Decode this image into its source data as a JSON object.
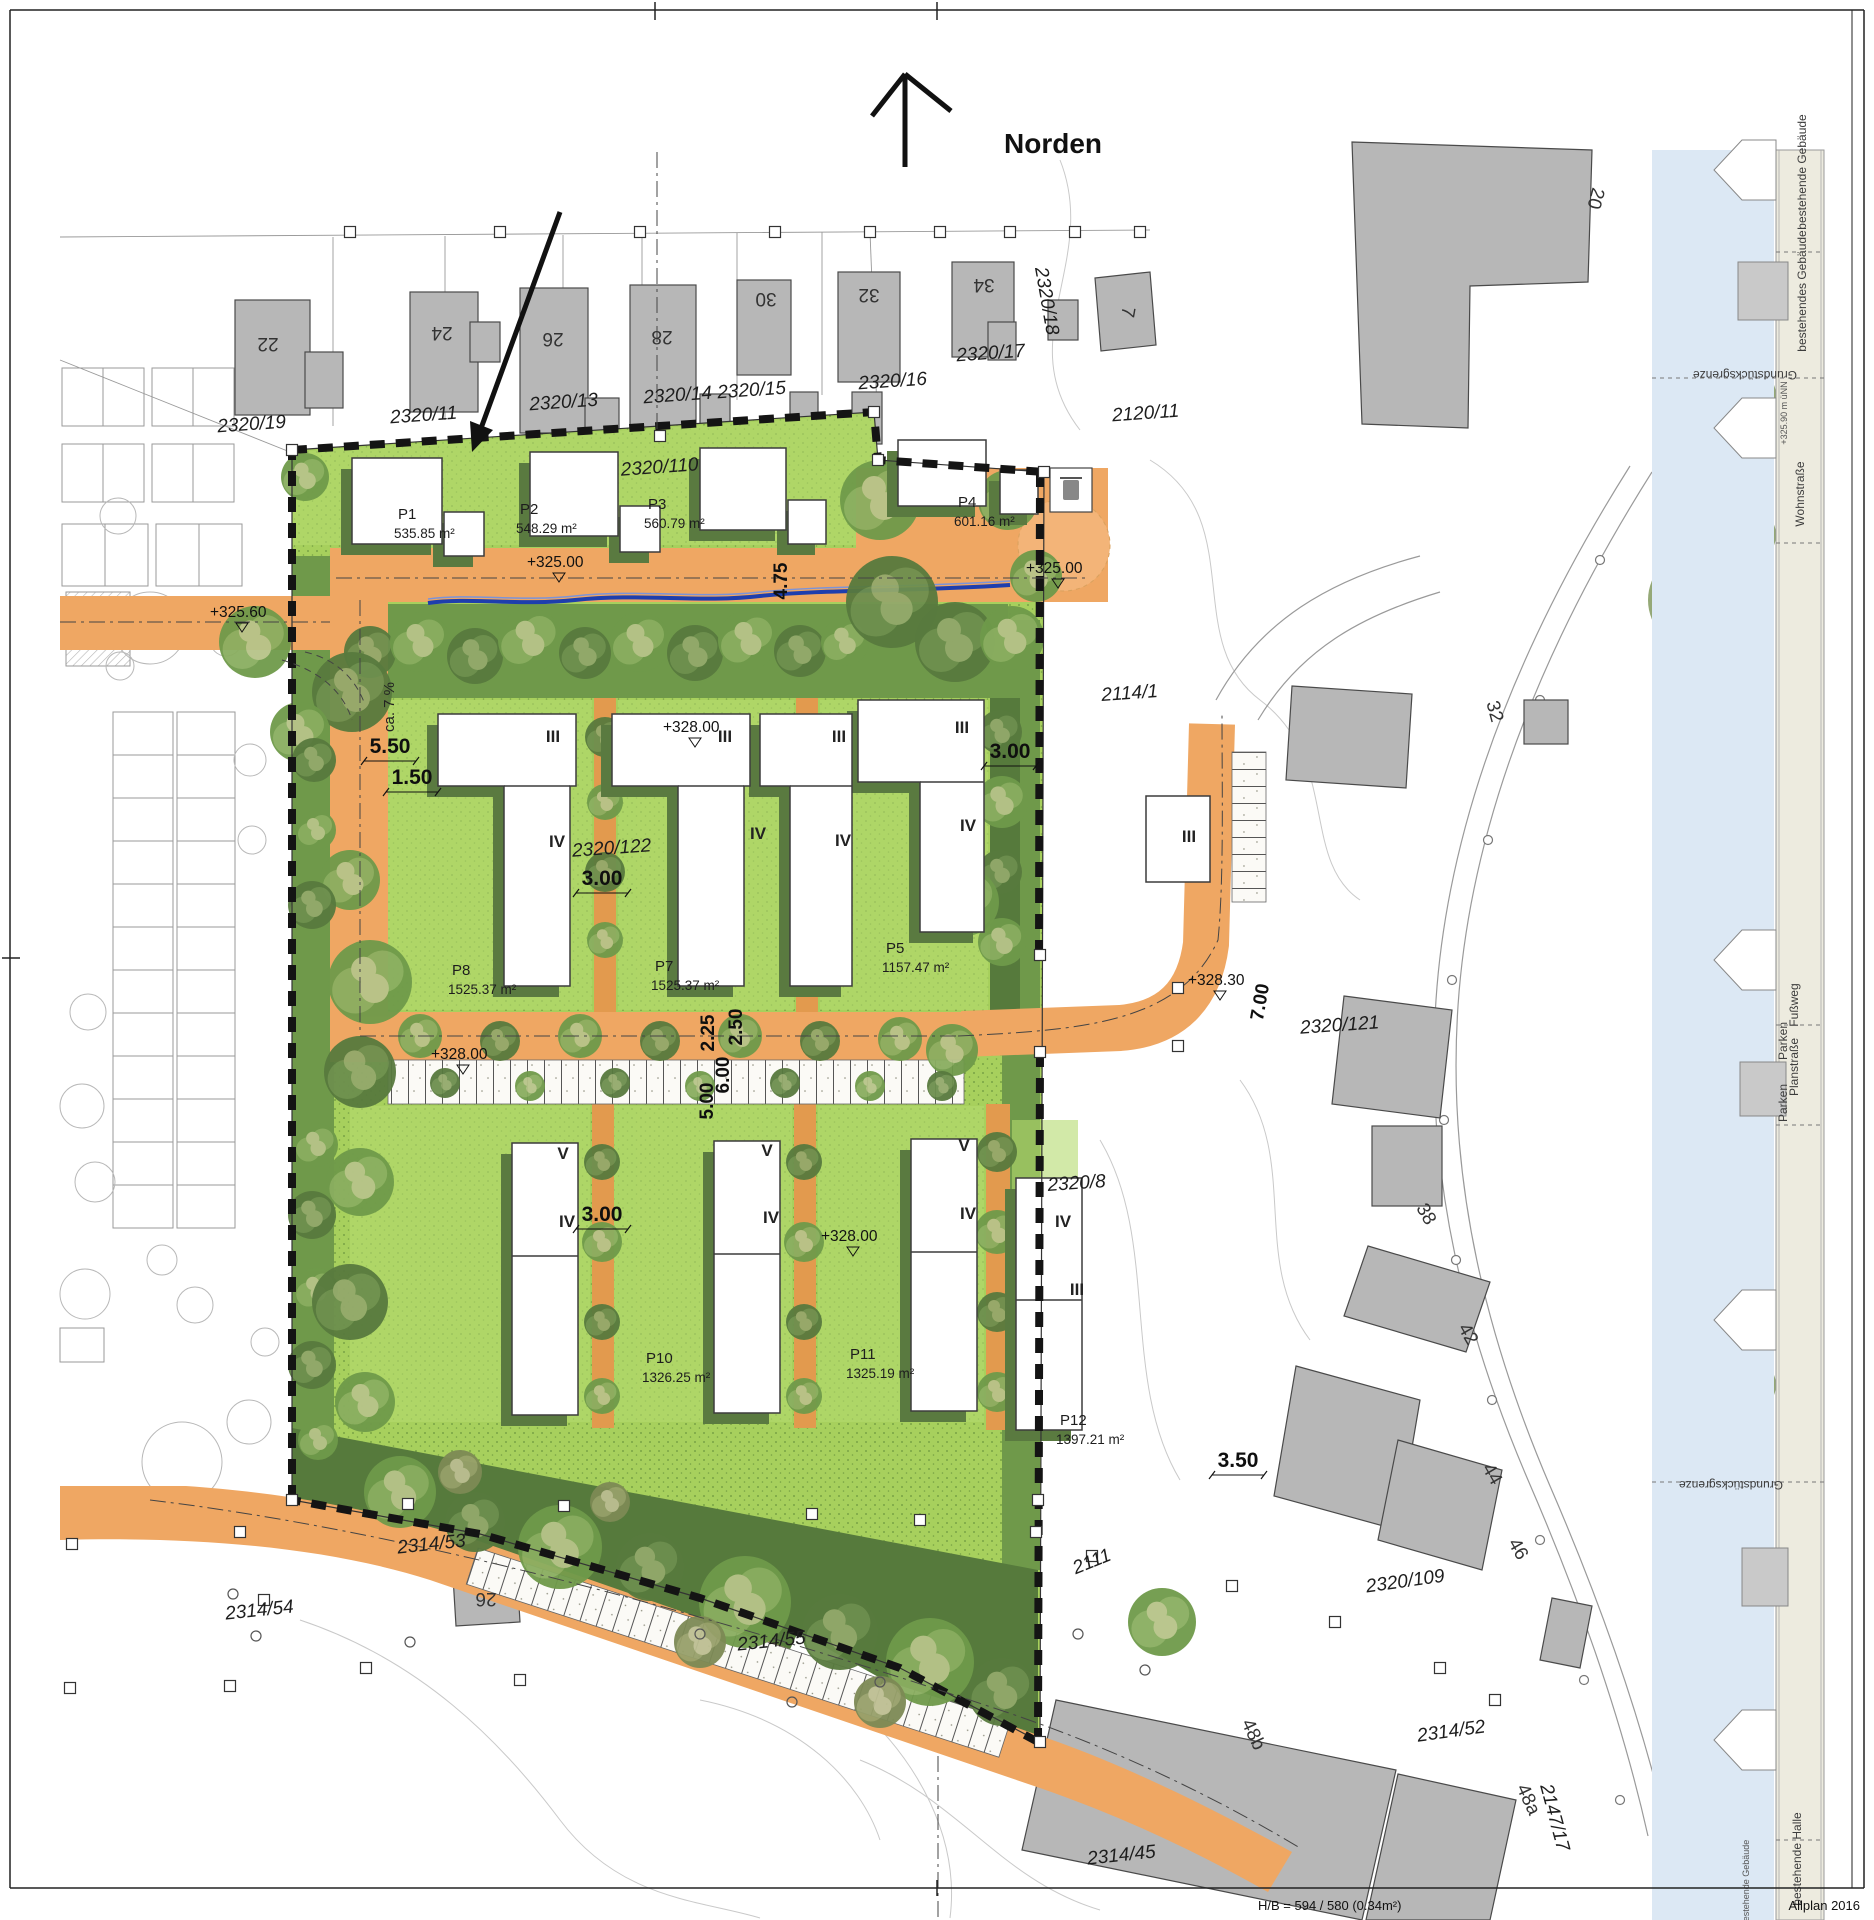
{
  "meta": {
    "north_label": "Norden",
    "footer_scale": "H/B = 594 / 580 (0.34m²)",
    "footer_app": "Allplan 2016"
  },
  "colors": {
    "site_green": "#a7d05d",
    "buffer_green": "#6f994a",
    "dark_green": "#567a3c",
    "road_orange": "#efa763",
    "existing_building_gray": "#b7b7b7",
    "new_building_white": "#ffffff",
    "shadow_olive": "#5a7a40",
    "swale_blue": "#1e3ead",
    "sky_blue": "#dce8f4"
  },
  "parcels": [
    [
      "P1",
      "535.85 m²",
      398,
      519
    ],
    [
      "P2",
      "548.29 m²",
      520,
      514
    ],
    [
      "P3",
      "560.79 m²",
      648,
      509
    ],
    [
      "P4",
      "601.16 m²",
      958,
      507
    ],
    [
      "P5",
      "1157.47 m²",
      886,
      953
    ],
    [
      "P7",
      "1525.37 m²",
      655,
      971
    ],
    [
      "P8",
      "1525.37 m²",
      452,
      975
    ],
    [
      "P10",
      "1326.25 m²",
      646,
      1363
    ],
    [
      "P11",
      "1325.19 m²",
      850,
      1359
    ],
    [
      "P12",
      "1397.21 m²",
      1060,
      1425
    ]
  ],
  "map": {
    "labels": [
      [
        "plot",
        "2320/19",
        252,
        430,
        -4
      ],
      [
        "plot",
        "2320/11",
        424,
        421,
        -4
      ],
      [
        "plot",
        "2320/13",
        564,
        408,
        -4
      ],
      [
        "plot",
        "2320/14",
        678,
        401,
        -4
      ],
      [
        "plot",
        "2320/15",
        752,
        396,
        -4
      ],
      [
        "plot",
        "2320/16",
        893,
        387,
        -4
      ],
      [
        "plot",
        "2320/17",
        991,
        359,
        -4
      ],
      [
        "plot",
        "2320/18",
        1041,
        302,
        80
      ],
      [
        "plot",
        "2120/11",
        1146,
        419,
        -4
      ],
      [
        "plot",
        "2320/110",
        660,
        473,
        -4
      ],
      [
        "plot",
        "2320/122",
        612,
        854,
        -4
      ],
      [
        "plot",
        "2114/1",
        1130,
        699,
        -4
      ],
      [
        "plot",
        "2320/121",
        1340,
        1031,
        -4
      ],
      [
        "plot",
        "2320/8",
        1077,
        1189,
        -4
      ],
      [
        "plot",
        "2111",
        1094,
        1567,
        -22
      ],
      [
        "plot",
        "2320/109",
        1406,
        1587,
        -8
      ],
      [
        "plot",
        "2314/53",
        432,
        1550,
        -6
      ],
      [
        "plot",
        "2314/54",
        260,
        1616,
        -6
      ],
      [
        "plot",
        "2314/55",
        772,
        1647,
        -6
      ],
      [
        "plot",
        "2314/52",
        1452,
        1737,
        -8
      ],
      [
        "plot",
        "2314/45",
        1122,
        1861,
        -6
      ],
      [
        "plot",
        "2147/17",
        1549,
        1819,
        75
      ],
      [
        "house",
        "22",
        268,
        338,
        180
      ],
      [
        "house",
        "24",
        442,
        327,
        180
      ],
      [
        "house",
        "26",
        553,
        333,
        180
      ],
      [
        "house",
        "28",
        662,
        331,
        180
      ],
      [
        "house",
        "30",
        766,
        293,
        180
      ],
      [
        "house",
        "32",
        869,
        289,
        180
      ],
      [
        "house",
        "34",
        984,
        279,
        180
      ],
      [
        "house",
        "7",
        1122,
        311,
        100
      ],
      [
        "house",
        "20",
        1590,
        197,
        105
      ],
      [
        "house",
        "32",
        1489,
        713,
        75
      ],
      [
        "house",
        "38",
        1421,
        1217,
        60
      ],
      [
        "house",
        "42",
        1463,
        1337,
        60
      ],
      [
        "house",
        "44",
        1487,
        1477,
        60
      ],
      [
        "house",
        "46",
        1513,
        1552,
        60
      ],
      [
        "house",
        "48b",
        1248,
        1737,
        65
      ],
      [
        "house",
        "48a",
        1523,
        1802,
        65
      ],
      [
        "house",
        "26",
        486,
        1593,
        180
      ],
      [
        "dim",
        "5.50",
        390,
        753
      ],
      [
        "dim",
        "1.50",
        412,
        784
      ],
      [
        "dim",
        "3.00",
        602,
        885
      ],
      [
        "dim",
        "3.00",
        1010,
        758
      ],
      [
        "dim",
        "3.00",
        602,
        1221
      ],
      [
        "dim",
        "3.50",
        1238,
        1467
      ],
      [
        "dimR",
        "2.25",
        714,
        1033,
        -90
      ],
      [
        "dimR",
        "2.50",
        742,
        1027,
        -90
      ],
      [
        "dimR",
        "6.00",
        729,
        1075,
        -90
      ],
      [
        "dimR",
        "5.00",
        713,
        1101,
        -90
      ],
      [
        "dimR",
        "7.00",
        1266,
        1003,
        -80
      ],
      [
        "dimR",
        "4.75",
        787,
        581,
        -90
      ],
      [
        "dimS",
        "ca. 7 %",
        394,
        707,
        -90
      ],
      [
        "elev",
        "+325.60",
        210,
        617
      ],
      [
        "elev",
        "+325.00",
        527,
        567
      ],
      [
        "elev",
        "+325.00",
        1026,
        573
      ],
      [
        "elev",
        "+328.00",
        663,
        732
      ],
      [
        "elev",
        "+328.00",
        431,
        1059
      ],
      [
        "elev",
        "+328.00",
        821,
        1241
      ],
      [
        "elev",
        "+328.30",
        1188,
        985
      ],
      [
        "floor",
        "III",
        553,
        742
      ],
      [
        "floor",
        "IV",
        557,
        847
      ],
      [
        "floor",
        "III",
        725,
        742
      ],
      [
        "floor",
        "IV",
        758,
        839
      ],
      [
        "floor",
        "III",
        839,
        742
      ],
      [
        "floor",
        "IV",
        843,
        846
      ],
      [
        "floor",
        "III",
        962,
        733
      ],
      [
        "floor",
        "IV",
        968,
        831
      ],
      [
        "floor",
        "III",
        1189,
        842
      ],
      [
        "floor",
        "V",
        563,
        1159
      ],
      [
        "floor",
        "IV",
        567,
        1227
      ],
      [
        "floor",
        "V",
        767,
        1156
      ],
      [
        "floor",
        "IV",
        771,
        1223
      ],
      [
        "floor",
        "V",
        964,
        1151
      ],
      [
        "floor",
        "IV",
        968,
        1219
      ],
      [
        "floor",
        "IV",
        1063,
        1227
      ],
      [
        "floor",
        "III",
        1077,
        1295
      ],
      [
        "strip",
        "bestehende Gebäude",
        1806,
        172,
        -90
      ],
      [
        "strip",
        "bestehendes Gebäude",
        1806,
        291,
        -90
      ],
      [
        "strip",
        "Grundstücksgrenze",
        1745,
        371,
        180
      ],
      [
        "tiny",
        "+325.90 m üNN",
        1787,
        413,
        -90
      ],
      [
        "strip",
        "Wohnstraße",
        1804,
        494,
        -90
      ],
      [
        "strip",
        "Fußweg",
        1798,
        1005,
        -90
      ],
      [
        "strip",
        "Parken",
        1787,
        1041,
        -90
      ],
      [
        "strip",
        "Planstraße",
        1798,
        1067,
        -90
      ],
      [
        "strip",
        "Parken",
        1787,
        1103,
        -90
      ],
      [
        "strip",
        "Grundstücksgrenze",
        1731,
        1481,
        180
      ],
      [
        "strip",
        "bestehende Halle",
        1801,
        1859,
        -90
      ],
      [
        "tiny",
        "bestehende Gebäude",
        1749,
        1883,
        -90
      ]
    ],
    "trees": [
      [
        370,
        652,
        26,
        0
      ],
      [
        420,
        642,
        30,
        1
      ],
      [
        475,
        656,
        28,
        0
      ],
      [
        530,
        640,
        32,
        1
      ],
      [
        585,
        653,
        26,
        0
      ],
      [
        640,
        642,
        30,
        1
      ],
      [
        695,
        653,
        28,
        0
      ],
      [
        748,
        640,
        30,
        1
      ],
      [
        800,
        651,
        26,
        0
      ],
      [
        845,
        642,
        24,
        1
      ],
      [
        880,
        500,
        40,
        1
      ],
      [
        948,
        478,
        34,
        1
      ],
      [
        1008,
        500,
        30,
        1
      ],
      [
        892,
        602,
        46,
        0
      ],
      [
        955,
        642,
        40,
        0
      ],
      [
        1012,
        638,
        32,
        1
      ],
      [
        1036,
        576,
        26,
        1
      ],
      [
        255,
        642,
        36,
        1
      ],
      [
        352,
        692,
        40,
        0
      ],
      [
        300,
        732,
        30,
        1
      ],
      [
        370,
        982,
        42,
        1
      ],
      [
        360,
        1072,
        36,
        0
      ],
      [
        350,
        880,
        30,
        1
      ],
      [
        314,
        760,
        22,
        0
      ],
      [
        316,
        830,
        20,
        1
      ],
      [
        312,
        905,
        24,
        0
      ],
      [
        316,
        1145,
        22,
        1
      ],
      [
        312,
        1215,
        24,
        0
      ],
      [
        316,
        1290,
        22,
        1
      ],
      [
        312,
        1365,
        24,
        0
      ],
      [
        318,
        1440,
        20,
        1
      ],
      [
        605,
        737,
        20,
        0
      ],
      [
        605,
        802,
        18,
        1
      ],
      [
        605,
        872,
        20,
        0
      ],
      [
        605,
        940,
        18,
        1
      ],
      [
        807,
        737,
        20,
        0
      ],
      [
        807,
        802,
        18,
        1
      ],
      [
        807,
        872,
        20,
        0
      ],
      [
        807,
        945,
        18,
        1
      ],
      [
        1000,
        732,
        22,
        0
      ],
      [
        1002,
        802,
        26,
        1
      ],
      [
        1000,
        872,
        22,
        0
      ],
      [
        1002,
        942,
        24,
        1
      ],
      [
        420,
        1036,
        22,
        1
      ],
      [
        500,
        1041,
        20,
        0
      ],
      [
        580,
        1036,
        22,
        1
      ],
      [
        660,
        1041,
        20,
        0
      ],
      [
        740,
        1036,
        22,
        1
      ],
      [
        820,
        1041,
        20,
        0
      ],
      [
        900,
        1039,
        22,
        1
      ],
      [
        952,
        1050,
        26,
        1
      ],
      [
        965,
        902,
        34,
        1
      ],
      [
        445,
        1083,
        15,
        0
      ],
      [
        530,
        1086,
        15,
        1
      ],
      [
        615,
        1083,
        15,
        0
      ],
      [
        700,
        1086,
        15,
        1
      ],
      [
        785,
        1083,
        15,
        0
      ],
      [
        870,
        1086,
        15,
        1
      ],
      [
        942,
        1086,
        15,
        0
      ],
      [
        602,
        1162,
        18,
        0
      ],
      [
        602,
        1242,
        20,
        1
      ],
      [
        602,
        1322,
        18,
        0
      ],
      [
        602,
        1396,
        18,
        1
      ],
      [
        804,
        1162,
        18,
        0
      ],
      [
        804,
        1242,
        20,
        1
      ],
      [
        804,
        1322,
        18,
        0
      ],
      [
        804,
        1396,
        18,
        1
      ],
      [
        997,
        1152,
        20,
        0
      ],
      [
        997,
        1232,
        22,
        1
      ],
      [
        997,
        1312,
        20,
        0
      ],
      [
        997,
        1392,
        20,
        1
      ],
      [
        360,
        1182,
        34,
        1
      ],
      [
        350,
        1302,
        38,
        0
      ],
      [
        365,
        1402,
        30,
        1
      ],
      [
        400,
        1492,
        36,
        1
      ],
      [
        475,
        1522,
        30,
        0
      ],
      [
        560,
        1547,
        42,
        1
      ],
      [
        650,
        1567,
        34,
        0
      ],
      [
        745,
        1602,
        46,
        1
      ],
      [
        840,
        1632,
        38,
        0
      ],
      [
        930,
        1662,
        44,
        1
      ],
      [
        1002,
        1692,
        34,
        0
      ],
      [
        700,
        1642,
        26,
        3
      ],
      [
        880,
        1702,
        26,
        3
      ],
      [
        460,
        1472,
        22,
        3
      ],
      [
        610,
        1502,
        20,
        3
      ],
      [
        1162,
        1622,
        34,
        1
      ],
      [
        305,
        477,
        24,
        1
      ],
      [
        1700,
        205,
        38,
        2
      ],
      [
        1700,
        330,
        42,
        2
      ],
      [
        1702,
        465,
        46,
        2
      ],
      [
        1698,
        600,
        50,
        2
      ],
      [
        1700,
        725,
        40,
        2
      ],
      [
        1702,
        845,
        42,
        2
      ],
      [
        1698,
        965,
        40,
        2
      ],
      [
        1700,
        1085,
        44,
        2
      ],
      [
        1702,
        1205,
        40,
        2
      ],
      [
        1698,
        1325,
        42,
        2
      ],
      [
        1700,
        1450,
        44,
        2
      ],
      [
        1702,
        1590,
        46,
        2
      ],
      [
        1698,
        1725,
        42,
        2
      ],
      [
        1700,
        1855,
        38,
        2
      ],
      [
        1748,
        260,
        24,
        2
      ],
      [
        1750,
        395,
        26,
        2
      ],
      [
        1748,
        535,
        28,
        2
      ],
      [
        1750,
        665,
        24,
        2
      ],
      [
        1748,
        785,
        22,
        2
      ],
      [
        1750,
        905,
        24,
        2
      ],
      [
        1748,
        1025,
        26,
        2
      ],
      [
        1750,
        1150,
        22,
        2
      ],
      [
        1748,
        1265,
        24,
        2
      ],
      [
        1750,
        1385,
        26,
        2
      ],
      [
        1748,
        1520,
        26,
        2
      ],
      [
        1750,
        1660,
        24,
        2
      ],
      [
        1748,
        1790,
        24,
        2
      ],
      [
        1746,
        1895,
        22,
        2
      ]
    ],
    "markers": [
      [
        350,
        232
      ],
      [
        500,
        232
      ],
      [
        640,
        232
      ],
      [
        775,
        232
      ],
      [
        870,
        232
      ],
      [
        940,
        232
      ],
      [
        1010,
        232
      ],
      [
        1075,
        232
      ],
      [
        1140,
        232
      ],
      [
        292,
        450
      ],
      [
        660,
        436
      ],
      [
        874,
        412
      ],
      [
        878,
        460
      ],
      [
        1044,
        472
      ],
      [
        1040,
        955
      ],
      [
        1040,
        1052
      ],
      [
        1038,
        1500
      ],
      [
        1040,
        1742
      ],
      [
        292,
        1500
      ],
      [
        408,
        1504
      ],
      [
        564,
        1506
      ],
      [
        812,
        1514
      ],
      [
        920,
        1520
      ],
      [
        1036,
        1532
      ],
      [
        1092,
        1556
      ],
      [
        1232,
        1586
      ],
      [
        1335,
        1622
      ],
      [
        1440,
        1668
      ],
      [
        1495,
        1700
      ],
      [
        240,
        1532
      ],
      [
        264,
        1600
      ],
      [
        230,
        1686
      ],
      [
        70,
        1688
      ],
      [
        366,
        1668
      ],
      [
        520,
        1680
      ],
      [
        1178,
        988
      ],
      [
        1178,
        1046
      ],
      [
        72,
        1544
      ]
    ],
    "circle_markers": [
      [
        233,
        1594
      ],
      [
        256,
        1636
      ],
      [
        700,
        1634
      ],
      [
        792,
        1702
      ],
      [
        880,
        1682
      ],
      [
        1078,
        1634
      ],
      [
        1145,
        1670
      ],
      [
        410,
        1642
      ]
    ]
  }
}
